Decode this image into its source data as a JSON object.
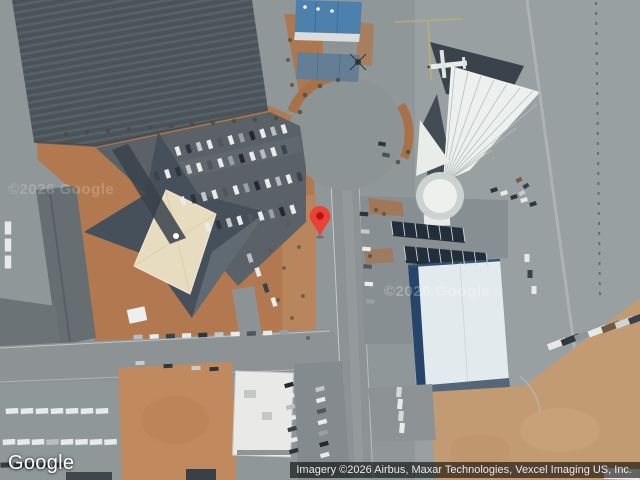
{
  "map": {
    "view_type": "satellite",
    "provider_logo": "Google",
    "attribution": "Imagery ©2026 Airbus, Maxar Technologies, Vexcel Imaging US, Inc.",
    "watermarks": {
      "left": "©2026 Google",
      "center": "©2026 Google"
    },
    "pin": {
      "color": "#EA4335",
      "stroke": "#C5221F",
      "dot_color": "#B31412"
    }
  }
}
